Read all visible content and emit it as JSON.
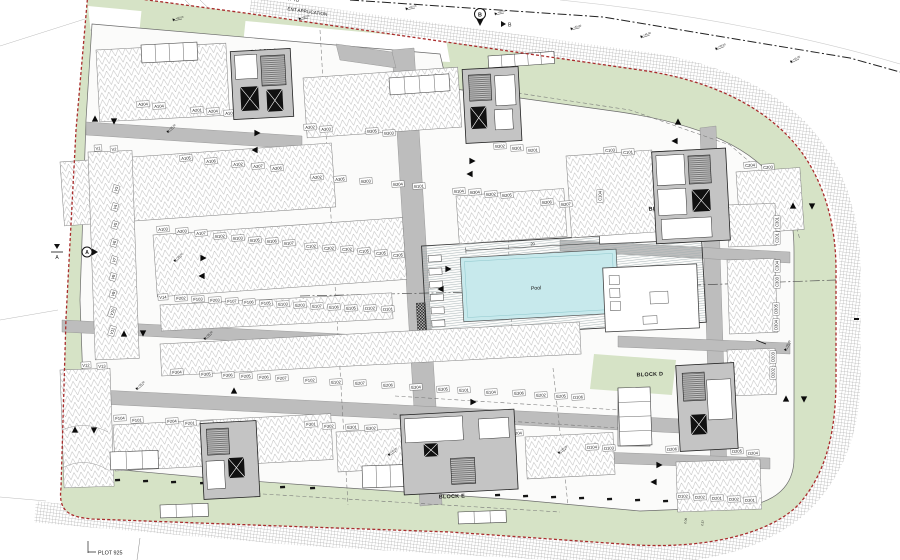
{
  "notes": {
    "top_left_line1": "NT TO",
    "top_left_line2": "ENT APPLICATION",
    "plot": "PLOT 925"
  },
  "pool": {
    "label": "Pool",
    "dim": "20"
  },
  "section_markers": {
    "pin_b": "B",
    "arrow_b": "B",
    "pin_a": "A",
    "edge_a": "A"
  },
  "level_marker_value": "+45.00",
  "dims": [
    "2.08",
    "2.57"
  ],
  "colors": {
    "boundary_red": "#a92c2c",
    "green": "#d6e3c6",
    "road_gray": "#bdbdbd",
    "core_gray": "#c4c4c4",
    "pool_blue": "#c7e9ec",
    "ink": "#1a1a1a"
  },
  "blocks": [
    [
      "BLOCK A",
      264,
      53,
      -3
    ],
    [
      "BLOC K B",
      482,
      80,
      -4
    ],
    [
      "BLOCK C",
      662,
      210,
      -3
    ],
    [
      "BLOCK D",
      650,
      376,
      -2
    ],
    [
      "BLOCK E",
      452,
      498,
      -2
    ],
    [
      "BLOCK F",
      232,
      489,
      -2
    ]
  ],
  "units": [
    [
      "A304",
      143,
      104,
      -3
    ],
    [
      "A104",
      159,
      106,
      -3
    ],
    [
      "A201",
      197,
      110,
      -3
    ],
    [
      "A204",
      213,
      111,
      -3
    ],
    [
      "A101",
      230,
      113,
      -3
    ],
    [
      "A302",
      310,
      127,
      -3
    ],
    [
      "A303",
      326,
      129,
      -3
    ],
    [
      "B305",
      372,
      131,
      -3
    ],
    [
      "B303",
      389,
      133,
      -3
    ],
    [
      "B302",
      500,
      146,
      -3
    ],
    [
      "B301",
      517,
      148,
      -3
    ],
    [
      "B201",
      533,
      150,
      -3
    ],
    [
      "A105",
      186,
      158,
      -4
    ],
    [
      "A106",
      211,
      161,
      -4
    ],
    [
      "A102",
      238,
      164,
      -4
    ],
    [
      "A207",
      258,
      166,
      -4
    ],
    [
      "A206",
      277,
      168,
      -4
    ],
    [
      "A202",
      317,
      177,
      -4
    ],
    [
      "A305",
      340,
      179,
      -4
    ],
    [
      "B203",
      366,
      181,
      -4
    ],
    [
      "B204",
      398,
      184,
      -4
    ],
    [
      "B101",
      419,
      186,
      -4
    ],
    [
      "B104",
      459,
      191,
      -4
    ],
    [
      "B304",
      475,
      192,
      -4
    ],
    [
      "B202",
      491,
      194,
      -4
    ],
    [
      "B205",
      507,
      195,
      -4
    ],
    [
      "B206",
      547,
      202,
      -4
    ],
    [
      "B207",
      566,
      204,
      -4
    ],
    [
      "C103",
      610,
      150,
      -4
    ],
    [
      "C101",
      628,
      152,
      -4
    ],
    [
      "C204",
      750,
      165,
      -4
    ],
    [
      "C203",
      768,
      167,
      -4
    ],
    [
      "A103",
      163,
      229,
      -4
    ],
    [
      "A203",
      182,
      231,
      -4
    ],
    [
      "A107",
      201,
      233,
      -4
    ],
    [
      "B102",
      220,
      236,
      -4
    ],
    [
      "B103",
      238,
      238,
      -4
    ],
    [
      "B105",
      255,
      240,
      -4
    ],
    [
      "B106",
      272,
      241,
      -4
    ],
    [
      "B107",
      289,
      243,
      -4
    ],
    [
      "C102",
      311,
      246,
      -4
    ],
    [
      "C202",
      329,
      248,
      -4
    ],
    [
      "C302",
      347,
      249,
      -4
    ],
    [
      "C105",
      364,
      251,
      -4
    ],
    [
      "C205",
      381,
      253,
      -4
    ],
    [
      "C305",
      398,
      255,
      -4
    ],
    [
      "V14",
      163,
      297,
      -3
    ],
    [
      "F202",
      181,
      298,
      -3
    ],
    [
      "F103",
      198,
      299,
      -3
    ],
    [
      "F203",
      215,
      300,
      -3
    ],
    [
      "F107",
      232,
      301,
      -3
    ],
    [
      "F106",
      249,
      302,
      -3
    ],
    [
      "F105",
      266,
      303,
      -3
    ],
    [
      "E103",
      283,
      304,
      -3
    ],
    [
      "E203",
      300,
      305,
      -3
    ],
    [
      "E107",
      317,
      306,
      -3
    ],
    [
      "E106",
      334,
      307,
      -3
    ],
    [
      "E105",
      351,
      308,
      -3
    ],
    [
      "D102",
      370,
      308,
      -3
    ],
    [
      "D101",
      388,
      309,
      -3
    ],
    [
      "F304",
      177,
      372,
      -3
    ],
    [
      "F305",
      206,
      374,
      -3
    ],
    [
      "F306",
      228,
      375,
      -3
    ],
    [
      "F205",
      246,
      376,
      -3
    ],
    [
      "F206",
      264,
      377,
      -3
    ],
    [
      "F207",
      282,
      378,
      -3
    ],
    [
      "F102",
      310,
      380,
      -3
    ],
    [
      "E102",
      336,
      382,
      -3
    ],
    [
      "E207",
      360,
      383,
      -3
    ],
    [
      "E206",
      388,
      385,
      -3
    ],
    [
      "E304",
      416,
      387,
      -3
    ],
    [
      "E305",
      443,
      389,
      -3
    ],
    [
      "E101",
      464,
      390,
      -3
    ],
    [
      "E104",
      491,
      392,
      -3
    ],
    [
      "E306",
      519,
      393,
      -3
    ],
    [
      "E202",
      541,
      395,
      -3
    ],
    [
      "E205",
      561,
      396,
      -3
    ],
    [
      "D106",
      578,
      397,
      -3
    ],
    [
      "F104",
      120,
      418,
      -3
    ],
    [
      "F101",
      137,
      420,
      -3
    ],
    [
      "F204",
      172,
      421,
      -3
    ],
    [
      "F201",
      190,
      423,
      -3
    ],
    [
      "F303",
      207,
      424,
      -3
    ],
    [
      "F301",
      311,
      424,
      -3
    ],
    [
      "F302",
      329,
      426,
      -3
    ],
    [
      "E301",
      352,
      427,
      -3
    ],
    [
      "E302",
      371,
      428,
      -3
    ],
    [
      "E303",
      480,
      431,
      -3
    ],
    [
      "E201",
      499,
      432,
      -3
    ],
    [
      "E204",
      517,
      433,
      -3
    ],
    [
      "D104",
      592,
      447,
      -3
    ],
    [
      "D103",
      609,
      448,
      -3
    ],
    [
      "D206",
      672,
      449,
      -3
    ],
    [
      "D205",
      737,
      451,
      -3
    ],
    [
      "D204",
      753,
      453,
      -3
    ],
    [
      "D102",
      683,
      496,
      -2
    ],
    [
      "D202",
      700,
      497,
      -2
    ],
    [
      "D201",
      717,
      498,
      -2
    ],
    [
      "D302",
      734,
      499,
      -2
    ],
    [
      "D301",
      750,
      500,
      -2
    ],
    [
      "C301",
      777,
      222,
      -90
    ],
    [
      "C201",
      777,
      238,
      -90
    ],
    [
      "C304",
      777,
      266,
      -90
    ],
    [
      "C303",
      777,
      282,
      -90
    ],
    [
      "D305",
      776,
      309,
      -90
    ],
    [
      "D304",
      776,
      325,
      -90
    ],
    [
      "D203",
      773,
      357,
      -90
    ],
    [
      "D202",
      773,
      373,
      -90
    ],
    [
      "C104",
      600,
      196,
      -90
    ],
    [
      "V1",
      98,
      148,
      -3
    ],
    [
      "V2",
      114,
      149,
      -3
    ],
    [
      "V3",
      116,
      189,
      -72
    ],
    [
      "V4",
      115,
      207,
      -72
    ],
    [
      "V5",
      115,
      225,
      -72
    ],
    [
      "V6",
      114,
      243,
      -72
    ],
    [
      "V7",
      114,
      260,
      -72
    ],
    [
      "V8",
      113,
      277,
      -72
    ],
    [
      "V9",
      113,
      294,
      -72
    ],
    [
      "V10",
      112,
      312,
      -72
    ],
    [
      "V11",
      112,
      331,
      -72
    ],
    [
      "V12",
      86,
      365,
      -3
    ],
    [
      "V13",
      102,
      366,
      -3
    ]
  ],
  "stalls": [
    [
      96,
      50,
      130,
      72,
      -3
    ],
    [
      303,
      78,
      155,
      60,
      -4
    ],
    [
      60,
      162,
      272,
      64,
      -4
    ],
    [
      456,
      196,
      108,
      48,
      -4
    ],
    [
      153,
      235,
      250,
      62,
      -4
    ],
    [
      160,
      305,
      232,
      26,
      -3
    ],
    [
      160,
      344,
      420,
      32,
      -3
    ],
    [
      113,
      425,
      218,
      46,
      -3
    ],
    [
      336,
      432,
      140,
      40,
      -3
    ],
    [
      525,
      437,
      88,
      42,
      -3
    ],
    [
      566,
      156,
      86,
      82,
      -4
    ],
    [
      736,
      172,
      64,
      62,
      -4
    ],
    [
      727,
      205,
      48,
      42,
      -2
    ],
    [
      727,
      260,
      48,
      74,
      -2
    ],
    [
      727,
      350,
      48,
      46,
      -2
    ],
    [
      676,
      462,
      84,
      50,
      -2
    ],
    [
      60,
      370,
      50,
      118,
      -2
    ],
    [
      88,
      152,
      44,
      208,
      -2
    ]
  ],
  "arrows": [
    [
      95,
      119,
      "u"
    ],
    [
      114,
      121,
      "d"
    ],
    [
      257,
      133,
      "r"
    ],
    [
      255,
      150,
      "l"
    ],
    [
      472,
      161,
      "r"
    ],
    [
      470,
      174,
      "l"
    ],
    [
      678,
      122,
      "u"
    ],
    [
      675,
      141,
      "l"
    ],
    [
      203,
      258,
      "r"
    ],
    [
      202,
      276,
      "l"
    ],
    [
      448,
      269,
      "r"
    ],
    [
      441,
      289,
      "l"
    ],
    [
      124,
      334,
      "u"
    ],
    [
      143,
      333,
      "d"
    ],
    [
      793,
      206,
      "u"
    ],
    [
      812,
      206,
      "d"
    ],
    [
      234,
      391,
      "u"
    ],
    [
      75,
      430,
      "u"
    ],
    [
      94,
      430,
      "d"
    ],
    [
      473,
      402,
      "r"
    ],
    [
      470,
      420,
      "l"
    ],
    [
      786,
      399,
      "u"
    ],
    [
      804,
      399,
      "d"
    ],
    [
      659,
      465,
      "r"
    ],
    [
      654,
      482,
      "l"
    ]
  ],
  "levels": [
    [
      173,
      21,
      -12
    ],
    [
      299,
      20,
      -12
    ],
    [
      406,
      10,
      -12
    ],
    [
      495,
      15,
      -12
    ],
    [
      571,
      30,
      -14
    ],
    [
      641,
      38,
      -18
    ],
    [
      716,
      50,
      -22
    ],
    [
      791,
      63,
      -26
    ],
    [
      168,
      133,
      -40
    ],
    [
      175,
      262,
      -40
    ],
    [
      205,
      340,
      -40
    ],
    [
      137,
      390,
      -40
    ],
    [
      389,
      456,
      -35
    ],
    [
      559,
      454,
      -35
    ],
    [
      786,
      351,
      -60
    ]
  ],
  "ticks": [
    [
      115,
      479
    ],
    [
      143,
      480
    ],
    [
      171,
      481
    ],
    [
      200,
      482
    ],
    [
      280,
      486
    ],
    [
      310,
      487
    ],
    [
      495,
      494
    ],
    [
      523,
      495
    ],
    [
      551,
      496
    ],
    [
      579,
      497
    ],
    [
      607,
      498
    ],
    [
      635,
      499
    ],
    [
      663,
      500
    ]
  ],
  "cell_structures": [
    [
      141,
      45,
      56,
      18,
      -3,
      4
    ],
    [
      389,
      78,
      60,
      17,
      -4,
      4
    ],
    [
      488,
      56,
      66,
      12,
      -4,
      5
    ],
    [
      160,
      505,
      48,
      13,
      -2,
      3
    ],
    [
      458,
      512,
      48,
      12,
      -2,
      3
    ],
    [
      110,
      452,
      48,
      18,
      -2,
      3
    ],
    [
      362,
      466,
      56,
      22,
      -2,
      4
    ],
    [
      618,
      388,
      32,
      58,
      -2,
      4
    ]
  ],
  "loungers": {
    "count": 6
  }
}
